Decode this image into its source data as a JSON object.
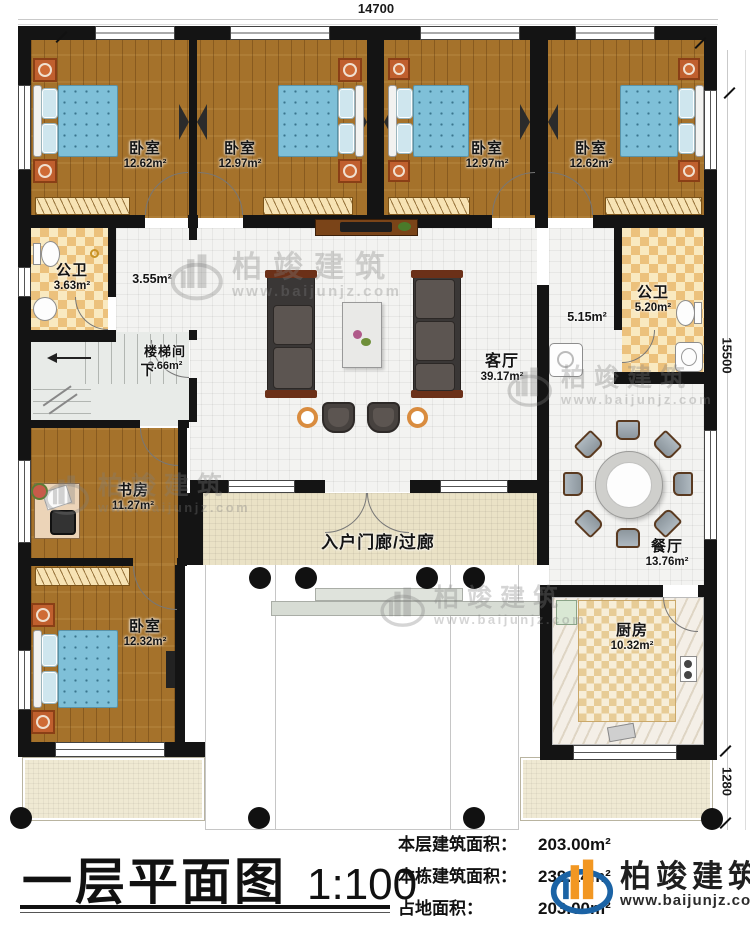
{
  "meta": {
    "title": "一层平面图",
    "scale": "1:100"
  },
  "dimensions": {
    "top": "14700",
    "right": "15500",
    "bottom_right": "1280"
  },
  "rooms": {
    "bedroom1": {
      "name": "卧室",
      "area": "12.62m²"
    },
    "bedroom2": {
      "name": "卧室",
      "area": "12.97m²"
    },
    "bedroom3": {
      "name": "卧室",
      "area": "12.97m²"
    },
    "bedroom4": {
      "name": "卧室",
      "area": "12.62m²"
    },
    "bathLeft": {
      "name": "公卫",
      "area": "3.63m²"
    },
    "hallLeft": {
      "area": "3.55m²"
    },
    "stair": {
      "name": "楼梯间",
      "area": "3.66m²",
      "down": "下"
    },
    "living": {
      "name": "客厅",
      "area": "39.17m²"
    },
    "hallRight": {
      "area": "5.15m²"
    },
    "bathRight": {
      "name": "公卫",
      "area": "5.20m²"
    },
    "study": {
      "name": "书房",
      "area": "11.27m²"
    },
    "bedroom5": {
      "name": "卧室",
      "area": "12.32m²"
    },
    "dining": {
      "name": "餐厅",
      "area": "13.76m²"
    },
    "kitchen": {
      "name": "厨房",
      "area": "10.32m²"
    },
    "porch": {
      "name": "入户门廊/过廊"
    }
  },
  "stats": [
    {
      "label": "本层建筑面积：",
      "value": "203.00m²"
    },
    {
      "label": "本栋建筑面积：",
      "value": "239.14m²"
    },
    {
      "label": "占地面积：",
      "value": "203.00m²"
    }
  ],
  "brand": {
    "name": "柏竣建筑",
    "url": "www.baijunjz.com"
  },
  "colors": {
    "wall": "#141414",
    "wood_floor": "#a5722b",
    "bed_blue": "#7fc0d8",
    "bath_tile": "#ecc17c",
    "kitchen_tile": "#e7cc96",
    "porch_tile": "#eae2c6",
    "accent_orange": "#d98c3f",
    "logo_blue": "#1b63a5",
    "logo_orange": "#f29722"
  }
}
